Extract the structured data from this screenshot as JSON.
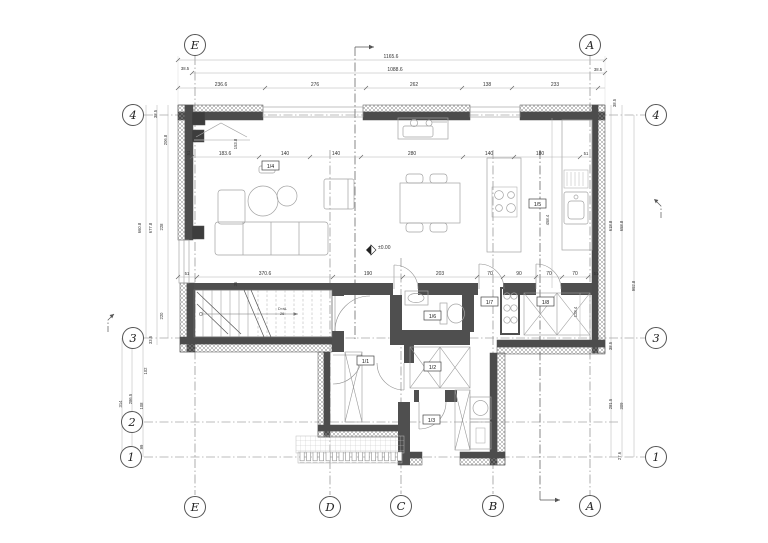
{
  "grid": {
    "top": [
      "E",
      "A"
    ],
    "bottom": [
      "E",
      "D",
      "C",
      "B",
      "A"
    ],
    "left": [
      "4",
      "3",
      "2",
      "1"
    ],
    "right": [
      "4",
      "3",
      "1"
    ]
  },
  "rooms": {
    "living": "1/4",
    "kitchen": "1/5",
    "bath": "1/6",
    "hall2": "1/7",
    "closet": "1/8",
    "entry": "1/1",
    "corridor": "1/2",
    "utility": "1/3"
  },
  "level_marker": "±0.00",
  "stair_note": {
    "line1": "D×śL",
    "line2": "26"
  },
  "dims": {
    "top": [
      "1165.6",
      "1088.6",
      "38.5",
      "236.6",
      "276",
      "262",
      "138",
      "233",
      "38.5"
    ],
    "upper": [
      "183.6",
      "153.8",
      "140",
      "140",
      "280",
      "140",
      "180",
      "51"
    ],
    "mid": [
      "51",
      "370.6",
      "190",
      "203",
      "70",
      "90",
      "70",
      "70",
      "51"
    ],
    "left": [
      "38.5",
      "206.8",
      "660.8",
      "677.8",
      "228",
      "220",
      "33.5",
      "102",
      "314",
      "286.5",
      "108",
      "99",
      "27.6"
    ],
    "right": [
      "38.5",
      "458.4",
      "128.4",
      "618.8",
      "658.8",
      "992.8",
      "38.5",
      "281.5",
      "309",
      "27.6"
    ],
    "misc": [
      "51",
      "35"
    ]
  }
}
